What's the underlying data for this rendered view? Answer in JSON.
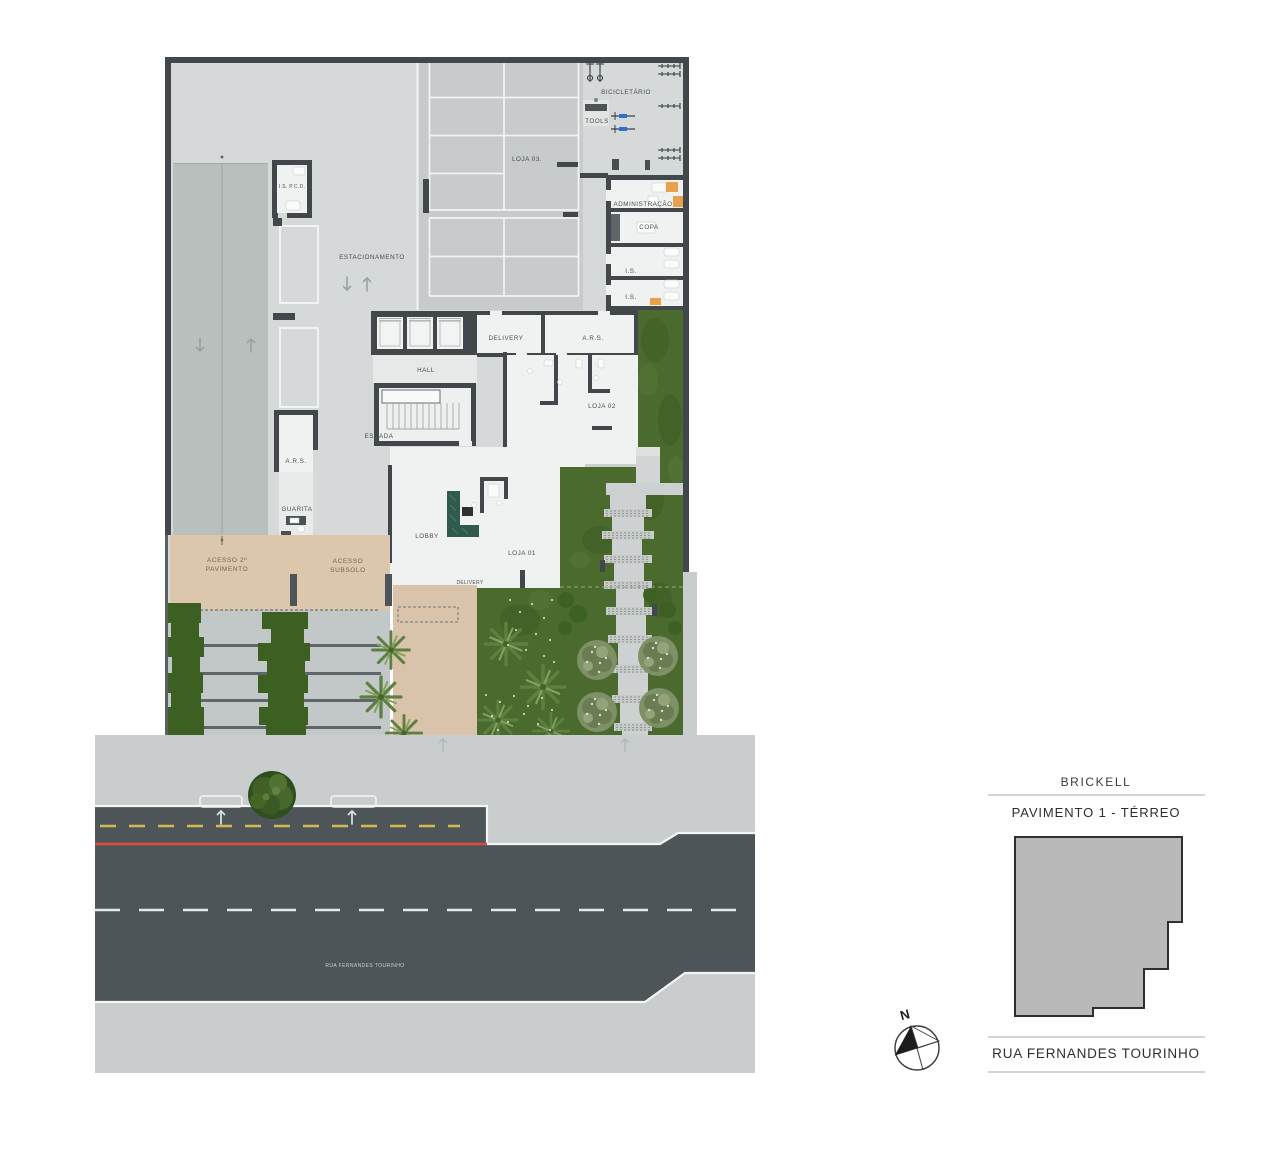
{
  "plan": {
    "labels": {
      "bicicletario": "BICICLETÁRIO",
      "tools": "TOOLS",
      "loja03": "LOJA 03.",
      "administracao": "ADMINISTRAÇÃO",
      "copa": "COPA",
      "is_1": "I.S.",
      "is_2": "I.S.",
      "is_pcd": "I.S. P.C.D.",
      "estacionamento": "ESTACIONAMENTO",
      "delivery": "DELIVERY",
      "ars_1": "A.R.S.",
      "hall": "HALL",
      "escada": "ESCADA",
      "loja02": "LOJA 02",
      "ars_2": "A.R.S.",
      "guarita": "GUARITA",
      "lobby": "LOBBY",
      "loja01": "LOJA 01",
      "delivery_2": "DELIVERY",
      "acesso_pavimento_l1": "ACESSO 2º",
      "acesso_pavimento_l2": "PAVIMENTO",
      "acesso_subsolo_l1": "ACESSO",
      "acesso_subsolo_l2": "SUBSOLO"
    },
    "street_name": "RUA FERNANDES TOURINHO"
  },
  "legend": {
    "project": "BRICKELL",
    "floor": "PAVIMENTO 1 - TÉRREO",
    "street": "RUA FERNANDES TOURINHO",
    "north": "N"
  },
  "colors": {
    "wall": "#41474b",
    "floor": "#d6d9da",
    "grass": "#4a6a2e",
    "road": "#4d5559",
    "sidewalk": "#c9cdce",
    "driveway_beige": "#dcc6ac",
    "yellow_line": "#d6ba50",
    "red_line": "#e2493c",
    "bike_blue": "#2e6fd0",
    "accent_orange": "#e8a04c",
    "desk_green": "#315a4e",
    "keyplan_fill": "#b9b9b9"
  }
}
